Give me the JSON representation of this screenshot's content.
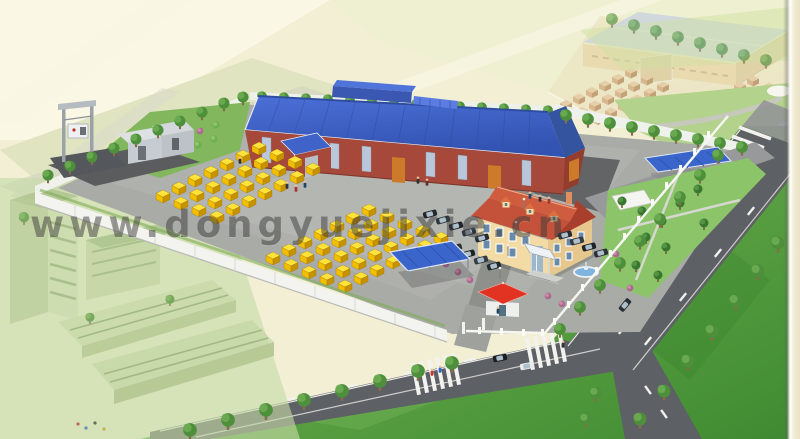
{
  "watermark": {
    "text": "www.dongyuejixie.cn"
  },
  "scene": {
    "palette": {
      "background_cream": "#f2efd5",
      "factory_roof_blue": "#3e62c8",
      "factory_wall_red": "#a6493a",
      "container_yellow": "#f2be00",
      "office_wall_cream": "#f2dba4",
      "office_roof_red": "#c4523a",
      "canopy_blue": "#3a66cc",
      "gatehouse_roof_red": "#e23322",
      "grass_green": "#5f9e44",
      "road_gray": "#5d6064",
      "wall_white": "#f3f3ef"
    }
  }
}
